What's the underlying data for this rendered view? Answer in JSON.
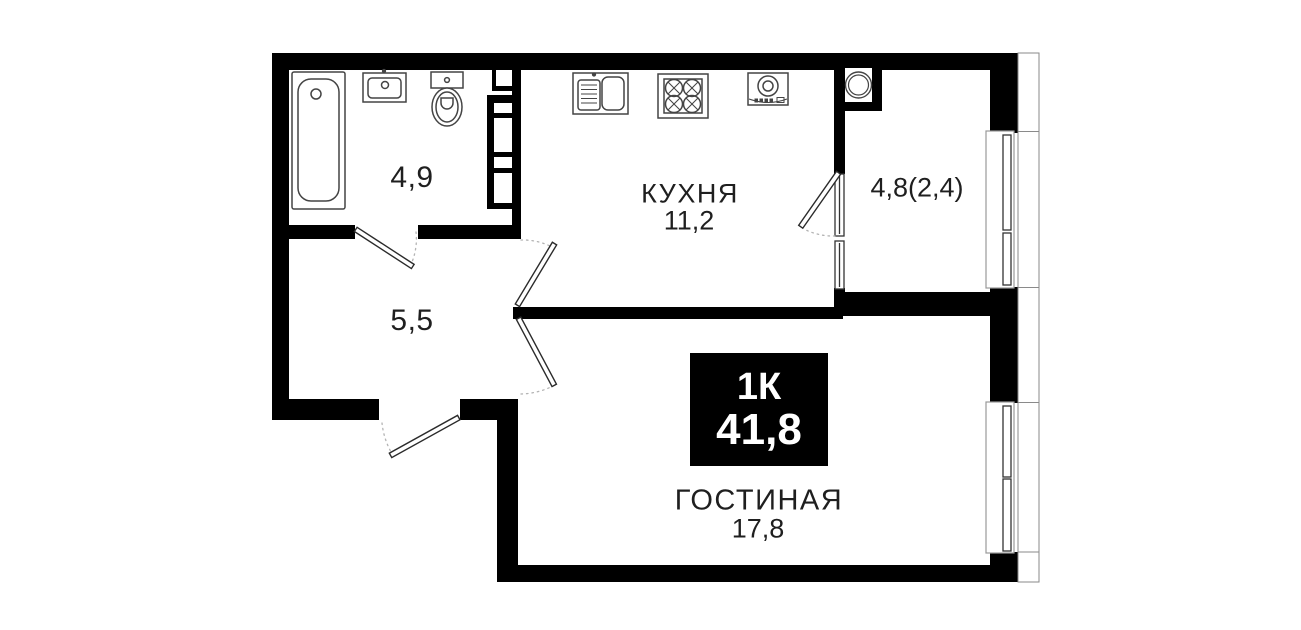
{
  "plan": {
    "badge": {
      "type_label": "1К",
      "total_area": "41,8"
    },
    "rooms": {
      "bathroom": {
        "area": "4,9"
      },
      "kitchen": {
        "name": "КУХНЯ",
        "area": "11,2"
      },
      "balcony": {
        "area": "4,8(2,4)"
      },
      "hallway": {
        "area": "5,5"
      },
      "living": {
        "name": "ГОСТИНАЯ",
        "area": "17,8"
      }
    },
    "colors": {
      "wall": "#000000",
      "text": "#1f1f1f",
      "badge_bg": "#000000",
      "badge_text": "#ffffff"
    }
  }
}
